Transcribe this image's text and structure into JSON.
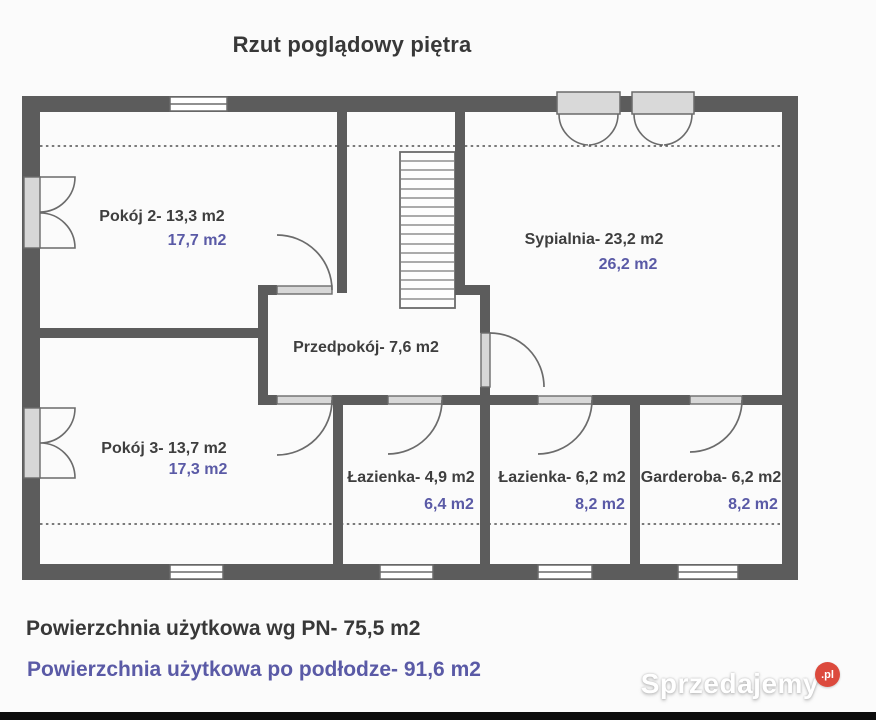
{
  "title": "Rzut poglądowy piętra",
  "plan": {
    "rooms": [
      {
        "label": "Pokój 2- 13,3 m2",
        "floor_area": "17,7 m2"
      },
      {
        "label": "Sypialnia- 23,2 m2",
        "floor_area": "26,2 m2"
      },
      {
        "label": "Przedpokój- 7,6 m2"
      },
      {
        "label": "Pokój 3- 13,7 m2",
        "floor_area": "17,3 m2"
      },
      {
        "label": "Łazienka- 4,9 m2",
        "floor_area": "6,4 m2"
      },
      {
        "label": "Łazienka- 6,2 m2",
        "floor_area": "8,2 m2"
      },
      {
        "label": "Garderoba- 6,2 m2",
        "floor_area": "8,2 m2"
      }
    ]
  },
  "summary": {
    "line1": "Powierzchnia użytkowa wg PN- 75,5 m2",
    "line2": "Powierzchnia użytkowa po podłodze- 91,6 m2"
  },
  "watermark": {
    "brand": "Sprzedajemy",
    "badge": ".pl"
  },
  "colors": {
    "wall": "#5c5c5c",
    "accent_blue": "#5a5aa6",
    "text_dark": "#3e3e3e",
    "badge_red": "#dc4a3d",
    "bottom_bar": "#0c0c0c"
  }
}
